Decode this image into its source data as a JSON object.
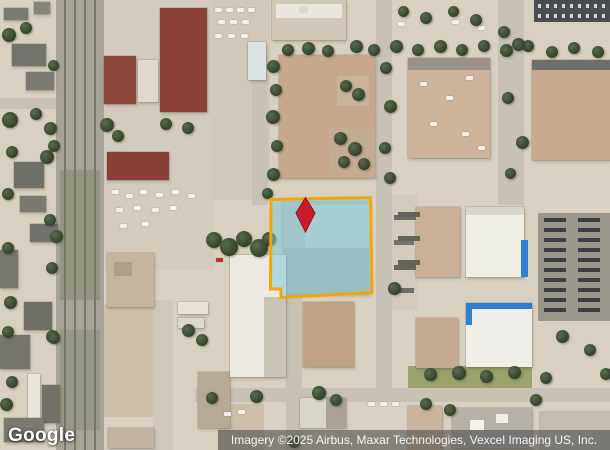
{
  "map": {
    "watermark": "Google",
    "attribution": "Imagery ©2025 Airbus, Maxar Technologies, Vexcel Imaging US, Inc.",
    "overlay": {
      "parcel": {
        "points": "271,199.5 370.5,197.5 372,292.5 281,297.5 281,289 270.5,289",
        "fill": "#7DCADE",
        "fill_opacity": "0.55",
        "stroke": "#F3A50B",
        "stroke_width": "3"
      },
      "pin": {
        "name": "location-pin",
        "points": "305.5,197.5 315,213 305.5,232 296,213",
        "color": "#C91B2A",
        "stroke": "#8E1420"
      }
    },
    "colors": {
      "ground": "#D8D1C1",
      "parcel_fill": "#7DCADE",
      "parcel_stroke": "#F3A50B",
      "pin_red": "#C91B2A",
      "tree_green": "#3C4A30",
      "maroon_roof": "#8C4036",
      "tan_roof": "#C8A88C",
      "white_roof": "#EBE9E1",
      "blue_trim": "#2E7FD2",
      "asphalt": "#4A4E53"
    }
  }
}
